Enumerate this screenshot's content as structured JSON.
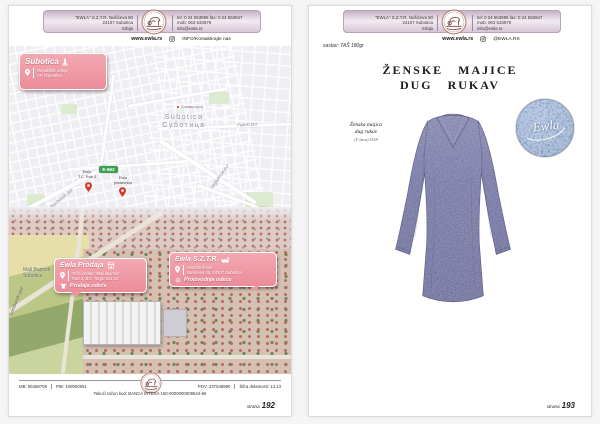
{
  "header": {
    "company_lines": [
      "\"EWLA\" S.Z.T.R. Nušićeva 50",
      "24107 Subotica",
      "Srbija"
    ],
    "contact_lines": [
      "tel: 0 24 553995  fax: 0 24 553947",
      "mob: 063 533979",
      "info@ewla.rs"
    ],
    "website": "www.ewla.rs",
    "social_left": "INFO/Kontaktirajte nas",
    "social_right": "@EWLA.RS"
  },
  "page_left": {
    "city_box": {
      "title": "Subotica",
      "line1": "Republika Srbija",
      "line2": "AP Vojvodina"
    },
    "map": {
      "city": "Subotica",
      "city_cyr": "Суботица",
      "poi": "Gradska kuća",
      "street_palic": "Palićki put",
      "street_sombor": "Somborski put",
      "street_segedin": "Segedinski put",
      "badge_e662": "E-662",
      "badge_300": "300",
      "badge_e75": "E75",
      "pin1_line1": "Ewla",
      "pin1_line2": "T.C. Rab 3",
      "pin2_line1": "Ewla",
      "pin2_line2": "prodavnica"
    },
    "photo": {
      "area_line1": "Mali Bajmok",
      "area_line2": "Subotica",
      "street": "Somborski put"
    },
    "store_box": {
      "title": "Ewla Prodaja",
      "addr1": "Tržni centar \"Mali Bajmok\"",
      "addr2": "Rab 3, B.c. Targo 511 23",
      "tag": "Prodaja odeće"
    },
    "hq_box": {
      "title": "Ewla S.Z.T.R.",
      "addr1": "Sedište firme:",
      "addr2": "Nušićeva 50, 24107 Subotica",
      "tag": "Proizvodnja odeće"
    },
    "footer": {
      "mb": "MB: 55468708",
      "pib": "PIB: 100900551",
      "pdv": "PDV: 237548990",
      "activity": "Šifra delatnosti: 14.13",
      "account": "Tekući račun kod: BANCA INTESA 160-0000000009544-66",
      "page_word": "strana",
      "page_num": "192"
    }
  },
  "page_right": {
    "material": "sastav: TAŠ 180gr",
    "title1": "ŽENSKE MAJICE",
    "title2": "DUG RUKAV",
    "caption1": "Ženska majica",
    "caption2": "dug rukav",
    "caption3": "(V izrez) 5118",
    "swatch_text": "Ewla",
    "footer": {
      "page_word": "strana",
      "page_num": "193"
    }
  },
  "colors": {
    "callout_pink": "#ef9aa5",
    "badge_green": "#3c9e4f",
    "shirt_heather": "#6f70a0",
    "swatch_blue": "#7b97c4",
    "header_lavender": "#d9c5d6"
  }
}
